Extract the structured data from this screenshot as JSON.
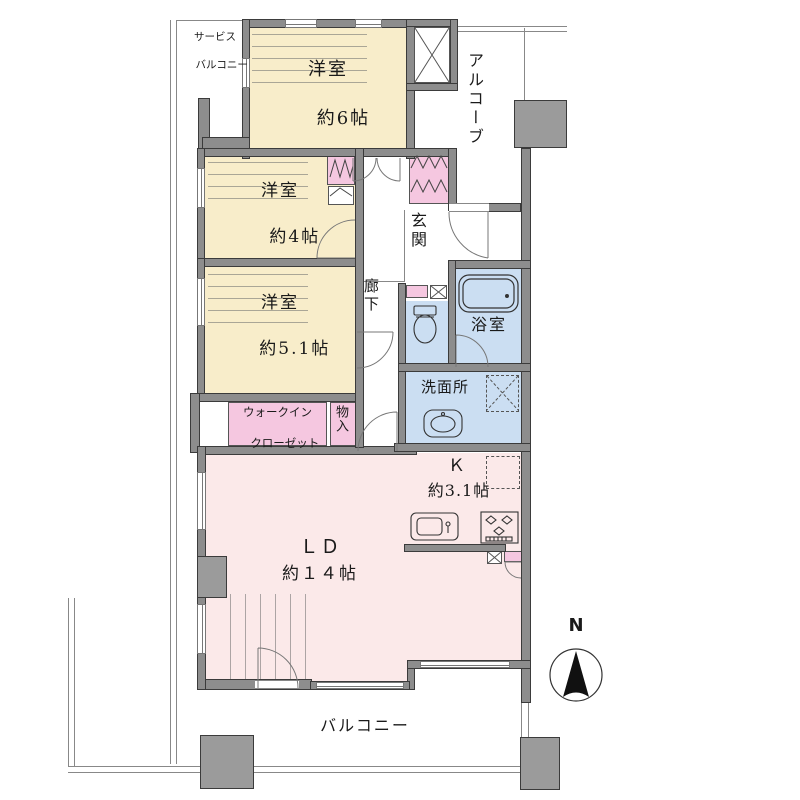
{
  "rooms": {
    "service_balcony": {
      "line1": "サービス",
      "line2": "バルコニー"
    },
    "western_6": {
      "name": "洋室",
      "size": "約6帖"
    },
    "alcove": {
      "name": "アルコーブ"
    },
    "western_4": {
      "name": "洋室",
      "size": "約4帖"
    },
    "entrance": {
      "name": "玄関"
    },
    "corridor": {
      "name": "廊下"
    },
    "bathroom": {
      "name": "浴室"
    },
    "western_5_1": {
      "name": "洋室",
      "size": "約5.1帖"
    },
    "washroom": {
      "name": "洗面所"
    },
    "walk_in_closet": {
      "line1": "ウォークイン",
      "line2": "クローゼット"
    },
    "storage": {
      "name": "物入"
    },
    "kitchen": {
      "name": "Ｋ",
      "size": "約3.1帖"
    },
    "living_dining": {
      "name": "ＬＤ",
      "size": "約１４帖"
    },
    "balcony": {
      "name": "バルコニー"
    }
  },
  "compass": {
    "north": "N"
  },
  "colors": {
    "wall": "#8d8d8d",
    "pillar": "#9b9b9b",
    "cream": "#f8edca",
    "rose": "#fbe9e9",
    "pink": "#f5c7e0",
    "blue": "#cbdef2",
    "outline": "#888888",
    "text": "#1a1a1a"
  }
}
